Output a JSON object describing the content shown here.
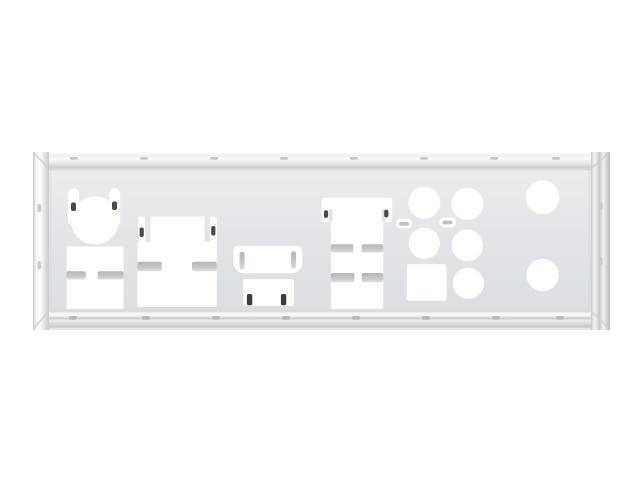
{
  "meta": {
    "kind": "product-photo",
    "subject": "Blank stainless-steel motherboard rear I/O shield back plate, shown face-on against a plain white background",
    "visible_text": ""
  },
  "colors": {
    "background": "#ffffff",
    "cutout": "#ffffff",
    "face_mid": "#e2e4e7",
    "finger_tab": "#bec1c5",
    "spring_tab_dark": "#46494d",
    "hdmi_tick_dark": "#3a3d41",
    "tick_mark": "#c3c6c9",
    "edge_shadow": "#c7cacd"
  },
  "parts": {
    "plate": {
      "name": "io-shield-plate",
      "finish": "polished-steel"
    },
    "cutouts": [
      {
        "name": "ps2-port-cutout",
        "shape": "circle with two spring-tab slots on top"
      },
      {
        "name": "usb-stack-cutout-left",
        "shape": "rectangle with two mid-height side fingers"
      },
      {
        "name": "dvi-port-cutout",
        "shape": "stepped rectangle with corner tabs and side fingers"
      },
      {
        "name": "hdmi-port-cutout",
        "shape": "wide rounded trapezoid with inner spring hooks"
      },
      {
        "name": "small-port-cutout",
        "shape": "rectangle with two dark bent tabs at bottom"
      },
      {
        "name": "lan-usb-cutout",
        "shape": "T-shaped rectangle with corner tabs and two finger pairs"
      },
      {
        "name": "vent-slot-left",
        "shape": "small rounded slot with punched bar"
      },
      {
        "name": "vent-slot-right",
        "shape": "small rounded slot with punched bar"
      },
      {
        "name": "audio-jack-cutouts",
        "shape": "cluster of five circles"
      },
      {
        "name": "optical-spdif-cutout",
        "shape": "square"
      },
      {
        "name": "antenna-hole-top",
        "shape": "large circle near right edge, upper"
      },
      {
        "name": "antenna-hole-bottom",
        "shape": "large circle near right edge, lower"
      }
    ]
  }
}
